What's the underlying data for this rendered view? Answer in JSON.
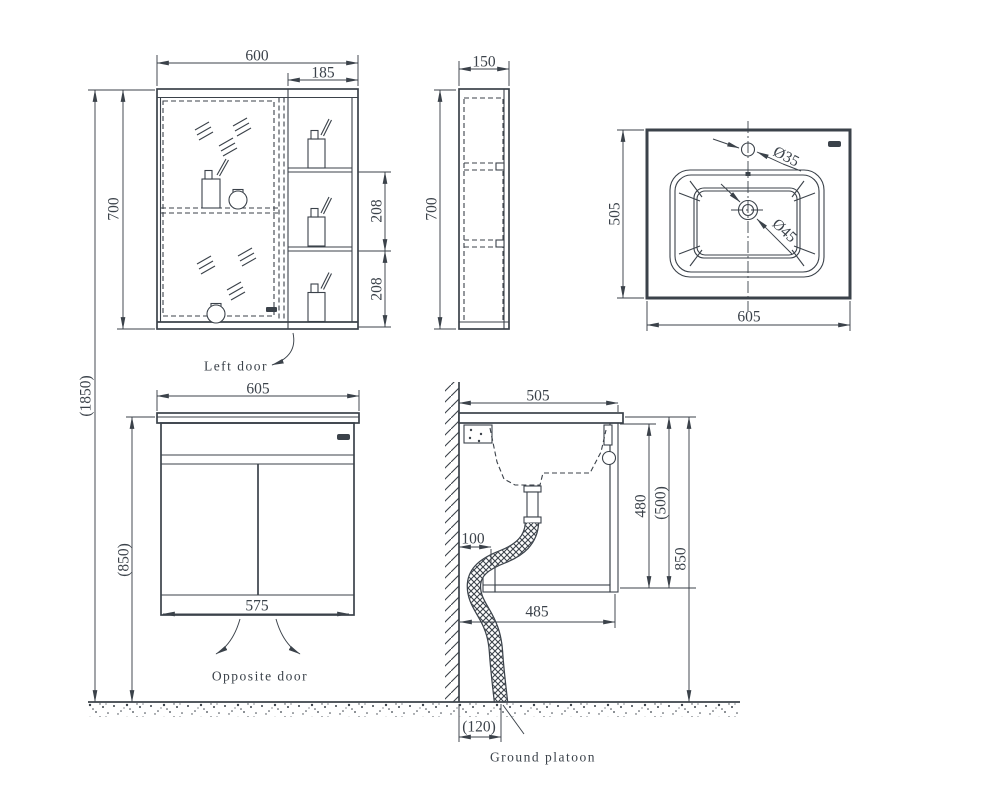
{
  "canvas": {
    "background": "#ffffff",
    "line_color": "#3b424a"
  },
  "views": {
    "mirror_cabinet_front": {
      "dims": {
        "width": "600",
        "shelf_width": "185",
        "height": "700",
        "shelf_gap_upper": "208",
        "shelf_gap_lower": "208"
      },
      "door_label": "Left door"
    },
    "mirror_cabinet_side": {
      "dims": {
        "depth": "150",
        "height": "700"
      }
    },
    "basin_top_view": {
      "dims": {
        "depth": "505",
        "width": "605",
        "faucet_hole": "Ø35",
        "drain_hole": "Ø45"
      }
    },
    "vanity_front": {
      "dims": {
        "width": "605",
        "height": "(850)",
        "door_width": "575"
      },
      "door_label": "Opposite door"
    },
    "installation_section": {
      "dims": {
        "top_depth": "505",
        "wall_clearance": "100",
        "cabinet_inner_height": "480",
        "cabinet_depth": "(500)",
        "worktop_height": "850",
        "bottom_depth": "485",
        "drain_offset": "(120)"
      },
      "drain_label": "Ground platoon"
    },
    "overall": {
      "dims": {
        "total_height": "(1850)"
      }
    }
  }
}
